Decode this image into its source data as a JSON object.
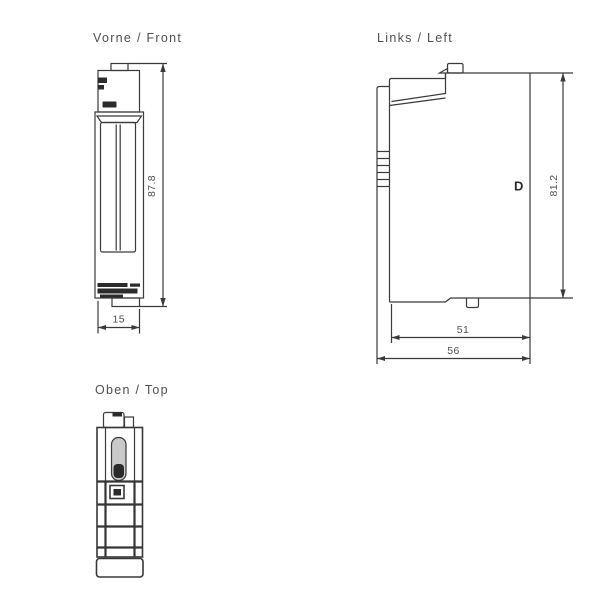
{
  "colors": {
    "background": "#ffffff",
    "line": "#3a3a3a",
    "text": "#4f4f4f",
    "dark_fill": "#2b2b2b",
    "slot_gray": "#c9c9c9"
  },
  "views": {
    "front": {
      "title": "Vorne / Front",
      "dims": {
        "height": "87.8",
        "width": "15"
      }
    },
    "left": {
      "title": "Links / Left",
      "marking": "D",
      "dims": {
        "height": "81.2",
        "depth_inner": "51",
        "depth_total": "56"
      }
    },
    "top": {
      "title": "Oben / Top"
    }
  }
}
